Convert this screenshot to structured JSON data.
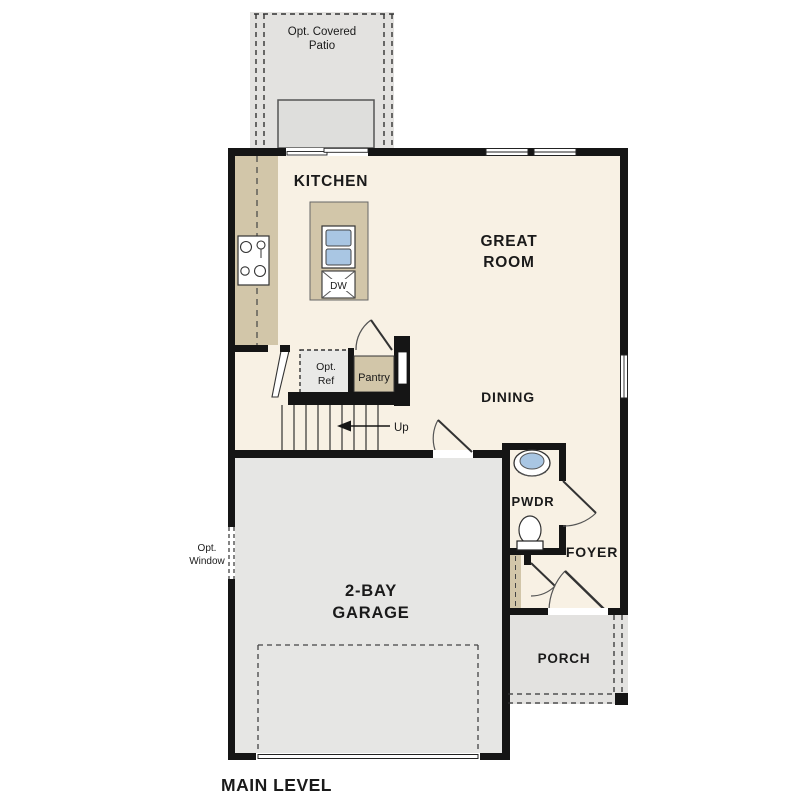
{
  "title": "MAIN LEVEL",
  "rooms": {
    "kitchen": "KITCHEN",
    "great_room_line1": "GREAT",
    "great_room_line2": "ROOM",
    "dining": "DINING",
    "pwdr": "PWDR",
    "foyer": "FOYER",
    "garage_line1": "2-BAY",
    "garage_line2": "GARAGE",
    "porch": "PORCH"
  },
  "annotations": {
    "patio_line1": "Opt. Covered",
    "patio_line2": "Patio",
    "opt_ref_line1": "Opt.",
    "opt_ref_line2": "Ref",
    "pantry": "Pantry",
    "up": "Up",
    "dw": "DW",
    "opt_window_line1": "Opt.",
    "opt_window_line2": "Window"
  },
  "colors": {
    "floor": "#f8f1e4",
    "garage": "#e6e6e4",
    "patio": "#e3e2e0",
    "patio_pad": "#dededc",
    "porch": "#e3e2e0",
    "counter": "#d2c6a9",
    "opt_ref_fill": "#e9e9e7",
    "sink_blue": "#a9c6e3",
    "wall": "#151515",
    "door_stroke": "#555555"
  }
}
